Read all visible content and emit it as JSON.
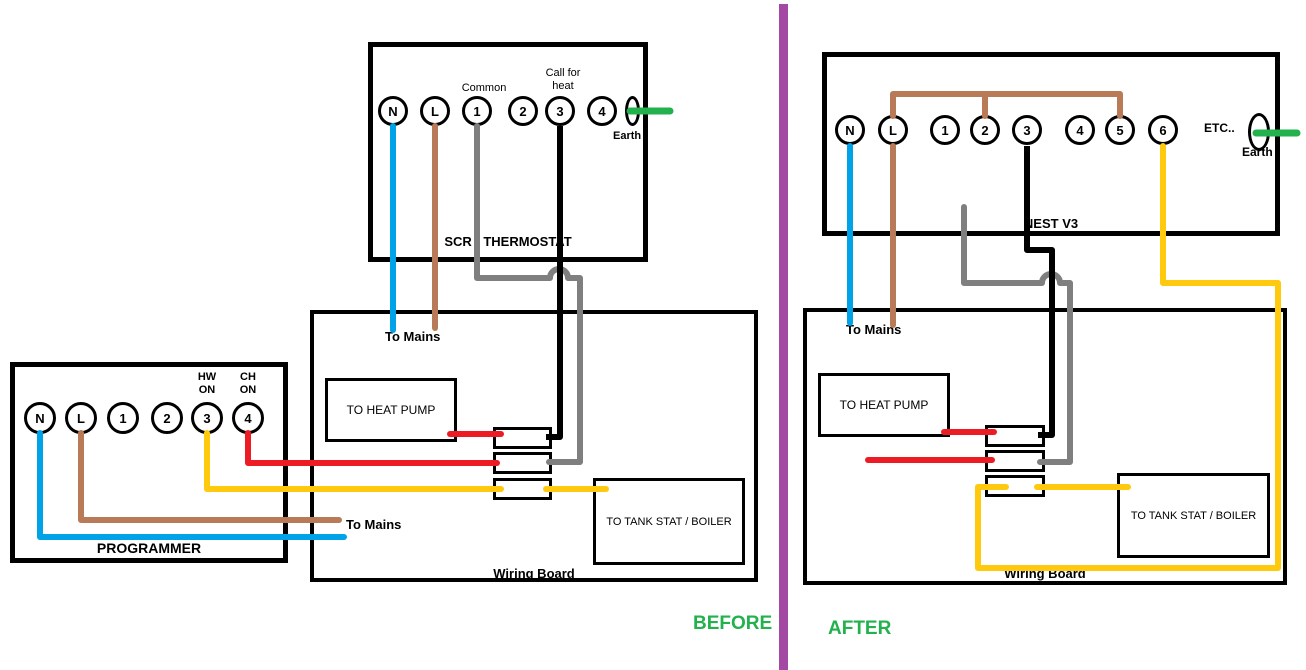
{
  "colors": {
    "blue": "#00A2E8",
    "brown": "#B97A57",
    "gray": "#7F7F7F",
    "yellow": "#FFC90E",
    "red": "#ED1C24",
    "green": "#22B14C",
    "purple": "#A349A4",
    "black": "#000000"
  },
  "before": {
    "caption": "BEFORE",
    "thermostat": {
      "label": "SCR - THERMOSTAT",
      "terminals": [
        "N",
        "L",
        "1",
        "2",
        "3",
        "4"
      ],
      "common_label": "Common",
      "call_for_heat_label": "Call for heat",
      "earth_label": "Earth"
    },
    "programmer": {
      "label": "PROGRAMMER",
      "terminals": [
        "N",
        "L",
        "1",
        "2",
        "3",
        "4"
      ],
      "hw_on_label": "HW ON",
      "ch_on_label": "CH ON"
    },
    "wiring_board": {
      "label": "Wiring Board",
      "heat_pump_label": "TO HEAT PUMP",
      "tank_stat_label": "TO TANK STAT / BOILER"
    },
    "to_mains_top": "To Mains",
    "to_mains_bottom": "To Mains"
  },
  "after": {
    "caption": "AFTER",
    "nest": {
      "label": "NEST V3",
      "terminals": [
        "N",
        "L",
        "1",
        "2",
        "3",
        "4",
        "5",
        "6"
      ],
      "etc_label": "ETC..",
      "earth_label": "Earth"
    },
    "wiring_board": {
      "label": "Wiring Board",
      "heat_pump_label": "TO HEAT PUMP",
      "tank_stat_label": "TO TANK STAT / BOILER"
    },
    "to_mains": "To Mains"
  }
}
